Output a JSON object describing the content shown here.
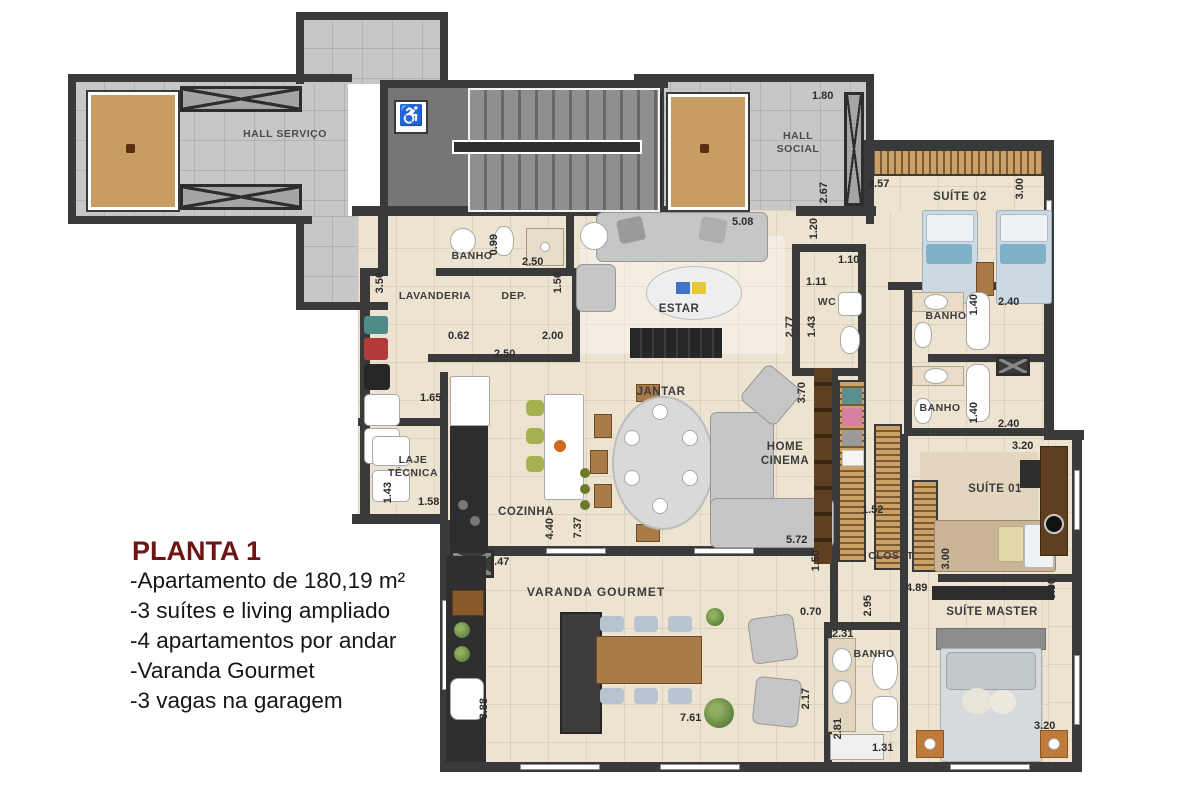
{
  "colors": {
    "wall": "#3a3a3a",
    "apartment_floor": "#ece3d1",
    "hall_floor": "#c7c7c7",
    "stair_floor": "#767676",
    "wood": "#c79d62",
    "title_accent": "#6e1414"
  },
  "info_panel": {
    "title": "PLANTA 1",
    "lines": [
      "-Apartamento de 180,19 m²",
      "-3 suítes e living ampliado",
      "-4 apartamentos por andar",
      "-Varanda Gourmet",
      "-3 vagas na garagem"
    ]
  },
  "rooms": {
    "hall_servico": "HALL SERVIÇO",
    "hall_social": "HALL SOCIAL",
    "banho_servico": "BANHO",
    "lavanderia": "LAVANDERIA",
    "dep": "DEP.",
    "estar": "ESTAR",
    "wc": "WC",
    "suite_02": "SUÍTE 02",
    "banho_suite_02": "BANHO",
    "banho_suite_01": "BANHO",
    "jantar": "JANTAR",
    "home_cinema": "HOME CINEMA",
    "laje_tecnica": "LAJE TÉCNICA",
    "cozinha": "COZINHA",
    "closet": "CLOSET",
    "suite_01": "SUÍTE 01",
    "varanda_gourmet": "VARANDA GOURMET",
    "suite_master": "SUÍTE MASTER",
    "banho_master": "BANHO"
  },
  "dims": [
    "1.80",
    "3.57",
    "3.00",
    "2.67",
    "5.08",
    "1.20",
    "1.10",
    "1.11",
    "2.77",
    "1.43",
    "0.99",
    "2.50",
    "1.50",
    "3.56",
    "0.62",
    "2.00",
    "2.50",
    "1.65",
    "3.70",
    "2.40",
    "1.40",
    "1.40",
    "2.40",
    "3.20",
    "1.43",
    "1.58",
    "1.52",
    "4.40",
    "7.37",
    "5.72",
    "1.50",
    "3.00",
    "4.89",
    "3.90",
    "0.70",
    "2.95",
    "2.31",
    "7.47",
    "2.17",
    "2.81",
    "1.31",
    "3.20",
    "3.88",
    "7.61"
  ],
  "icons": {
    "wheelchair": "♿"
  }
}
